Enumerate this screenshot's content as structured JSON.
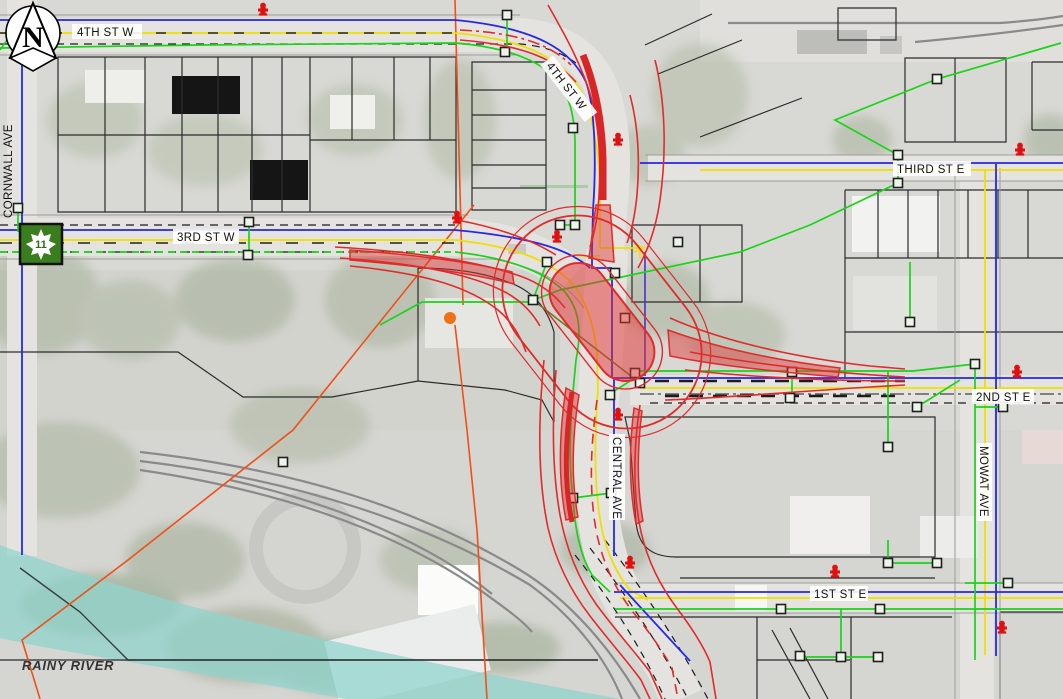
{
  "map": {
    "streets": {
      "fourth_st_w_top": "4TH ST W",
      "fourth_st_w_curve": "4TH ST W",
      "third_st_w": "3RD ST W",
      "third_st_e": "THIRD ST E",
      "second_st_e": "2ND ST E",
      "first_st_e": "1ST ST E",
      "central_ave": "CENTRAL AVE",
      "mowat_ave": "MOWAT AVE",
      "cornwall_ave": "CORNWALL AVE"
    },
    "water_features": {
      "rainy_river": "RAINY RIVER"
    },
    "north_arrow": {
      "letter": "N"
    },
    "route_marker": {
      "highway_number": "11"
    },
    "colors": {
      "design_red": "#e12b2b",
      "design_fill_pink": "rgba(227,50,50,0.45)",
      "water_main_blue": "#2727e8",
      "secondary_main_indigo": "#4a2fd0",
      "gas_line_yellow": "#f0df00",
      "sewer_green": "#19d419",
      "boundary_orange": "#f05018",
      "river_teal": "#8fd4cd",
      "rail_gray": "#8a8a8a",
      "parcel_black": "#2b2b2b",
      "hydrant_red": "#e01010",
      "route_marker_green": "#3a7d1e"
    }
  }
}
